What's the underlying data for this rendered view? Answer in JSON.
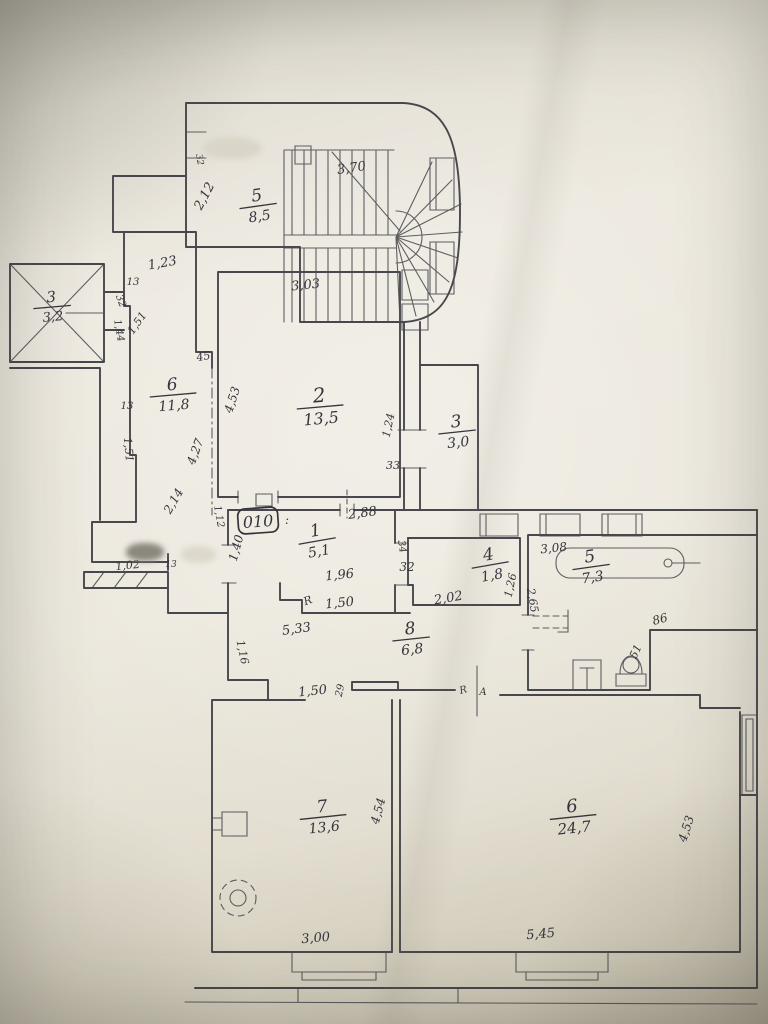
{
  "plan": {
    "description": "hand-drawn apartment floor plan",
    "colors": {
      "ink": "#3b3a41",
      "ink_thin": "#4b4a50",
      "paper": "#ebe7dc"
    },
    "apartment_plate": {
      "label": "010",
      "suffix": ":"
    },
    "rooms": [
      {
        "id": "staircase",
        "number": "5",
        "area": "8,5",
        "x": 258,
        "y": 205,
        "rot": -8,
        "num_size": 17,
        "area_size": 14
      },
      {
        "id": "elevator",
        "number": "3",
        "area": "3,2",
        "x": 52,
        "y": 306,
        "rot": -5,
        "num_size": 15,
        "area_size": 13
      },
      {
        "id": "corridor-6",
        "number": "6",
        "area": "11,8",
        "x": 173,
        "y": 394,
        "rot": -5,
        "num_size": 17,
        "area_size": 14
      },
      {
        "id": "room-2",
        "number": "2",
        "area": "13,5",
        "x": 320,
        "y": 406,
        "rot": -5,
        "num_size": 20,
        "area_size": 16
      },
      {
        "id": "room-3",
        "number": "3",
        "area": "3,0",
        "x": 457,
        "y": 431,
        "rot": -6,
        "num_size": 17,
        "area_size": 14
      },
      {
        "id": "hall-1",
        "number": "1",
        "area": "5,1",
        "x": 317,
        "y": 540,
        "rot": -10,
        "num_size": 17,
        "area_size": 14
      },
      {
        "id": "room-4",
        "number": "4",
        "area": "1,8",
        "x": 490,
        "y": 564,
        "rot": -10,
        "num_size": 17,
        "area_size": 14
      },
      {
        "id": "bathroom-5",
        "number": "5",
        "area": "7,3",
        "x": 591,
        "y": 566,
        "rot": -8,
        "num_size": 17,
        "area_size": 14
      },
      {
        "id": "corridor-8",
        "number": "8",
        "area": "6,8",
        "x": 411,
        "y": 638,
        "rot": -6,
        "num_size": 17,
        "area_size": 14
      },
      {
        "id": "room-7",
        "number": "7",
        "area": "13,6",
        "x": 323,
        "y": 816,
        "rot": -6,
        "num_size": 17,
        "area_size": 14
      },
      {
        "id": "room-6",
        "number": "6",
        "area": "24,7",
        "x": 573,
        "y": 816,
        "rot": -6,
        "num_size": 18,
        "area_size": 15
      }
    ],
    "dimensions": [
      {
        "text": "3,70",
        "x": 352,
        "y": 172,
        "rot": -8,
        "size": 13
      },
      {
        "text": "32",
        "x": 197,
        "y": 160,
        "rot": 80,
        "size": 9
      },
      {
        "text": "2,12",
        "x": 208,
        "y": 198,
        "rot": -62,
        "size": 13
      },
      {
        "text": "1,23",
        "x": 163,
        "y": 267,
        "rot": -10,
        "size": 13
      },
      {
        "text": "13",
        "x": 133,
        "y": 285,
        "rot": 0,
        "size": 10
      },
      {
        "text": "32",
        "x": 118,
        "y": 302,
        "rot": 70,
        "size": 10
      },
      {
        "text": "1,51",
        "x": 140,
        "y": 325,
        "rot": -55,
        "size": 11
      },
      {
        "text": "1,44",
        "x": 116,
        "y": 331,
        "rot": 80,
        "size": 10
      },
      {
        "text": "45",
        "x": 204,
        "y": 360,
        "rot": -10,
        "size": 11
      },
      {
        "text": "13",
        "x": 127,
        "y": 409,
        "rot": 0,
        "size": 10
      },
      {
        "text": "1,51",
        "x": 125,
        "y": 450,
        "rot": 85,
        "size": 11
      },
      {
        "text": "4,27",
        "x": 199,
        "y": 453,
        "rot": -70,
        "size": 12
      },
      {
        "text": "4,53",
        "x": 236,
        "y": 401,
        "rot": -72,
        "size": 12
      },
      {
        "text": "3,03",
        "x": 306,
        "y": 289,
        "rot": -6,
        "size": 13
      },
      {
        "text": "1,24",
        "x": 392,
        "y": 426,
        "rot": -78,
        "size": 11
      },
      {
        "text": "33",
        "x": 393,
        "y": 469,
        "rot": 0,
        "size": 11
      },
      {
        "text": "2,14",
        "x": 177,
        "y": 503,
        "rot": -60,
        "size": 12
      },
      {
        "text": "1,12",
        "x": 216,
        "y": 517,
        "rot": 80,
        "size": 10
      },
      {
        "text": "1,40",
        "x": 240,
        "y": 549,
        "rot": -75,
        "size": 12
      },
      {
        "text": "2,88",
        "x": 363,
        "y": 517,
        "rot": -8,
        "size": 13
      },
      {
        "text": "34",
        "x": 399,
        "y": 547,
        "rot": 80,
        "size": 10
      },
      {
        "text": "32",
        "x": 407,
        "y": 571,
        "rot": 0,
        "size": 12
      },
      {
        "text": "1,96",
        "x": 340,
        "y": 579,
        "rot": -6,
        "size": 13
      },
      {
        "text": "R",
        "x": 309,
        "y": 604,
        "rot": -20,
        "size": 11
      },
      {
        "text": "1,50",
        "x": 340,
        "y": 607,
        "rot": -6,
        "size": 13
      },
      {
        "text": "5,33",
        "x": 297,
        "y": 633,
        "rot": -8,
        "size": 13
      },
      {
        "text": "1,16",
        "x": 239,
        "y": 653,
        "rot": 78,
        "size": 11
      },
      {
        "text": "1,02",
        "x": 128,
        "y": 569,
        "rot": -6,
        "size": 11
      },
      {
        "text": "13",
        "x": 171,
        "y": 567,
        "rot": 0,
        "size": 9
      },
      {
        "text": "2,02",
        "x": 449,
        "y": 602,
        "rot": -10,
        "size": 13
      },
      {
        "text": "1,26",
        "x": 514,
        "y": 586,
        "rot": -78,
        "size": 11
      },
      {
        "text": "3,08",
        "x": 554,
        "y": 552,
        "rot": -6,
        "size": 12
      },
      {
        "text": "2,65",
        "x": 529,
        "y": 601,
        "rot": 80,
        "size": 11
      },
      {
        "text": "86",
        "x": 661,
        "y": 623,
        "rot": -15,
        "size": 12
      },
      {
        "text": "51",
        "x": 639,
        "y": 653,
        "rot": -65,
        "size": 11
      },
      {
        "text": "1,50",
        "x": 313,
        "y": 695,
        "rot": -6,
        "size": 13
      },
      {
        "text": "29",
        "x": 343,
        "y": 691,
        "rot": -78,
        "size": 10
      },
      {
        "text": "R",
        "x": 464,
        "y": 693,
        "rot": -15,
        "size": 10
      },
      {
        "text": "A",
        "x": 483,
        "y": 695,
        "rot": 0,
        "size": 10
      },
      {
        "text": "4,54",
        "x": 382,
        "y": 812,
        "rot": -75,
        "size": 12
      },
      {
        "text": "4,53",
        "x": 690,
        "y": 830,
        "rot": -72,
        "size": 12
      },
      {
        "text": "3,00",
        "x": 316,
        "y": 942,
        "rot": -5,
        "size": 13
      },
      {
        "text": "5,45",
        "x": 541,
        "y": 938,
        "rot": -5,
        "size": 13
      }
    ],
    "smudges": [
      {
        "x": 126,
        "y": 543,
        "w": 38,
        "h": 18,
        "color": "#8b887e"
      },
      {
        "x": 181,
        "y": 546,
        "w": 35,
        "h": 17,
        "color": "#dcd8cb"
      },
      {
        "x": 203,
        "y": 137,
        "w": 58,
        "h": 22,
        "color": "#d9d5c8"
      }
    ]
  }
}
